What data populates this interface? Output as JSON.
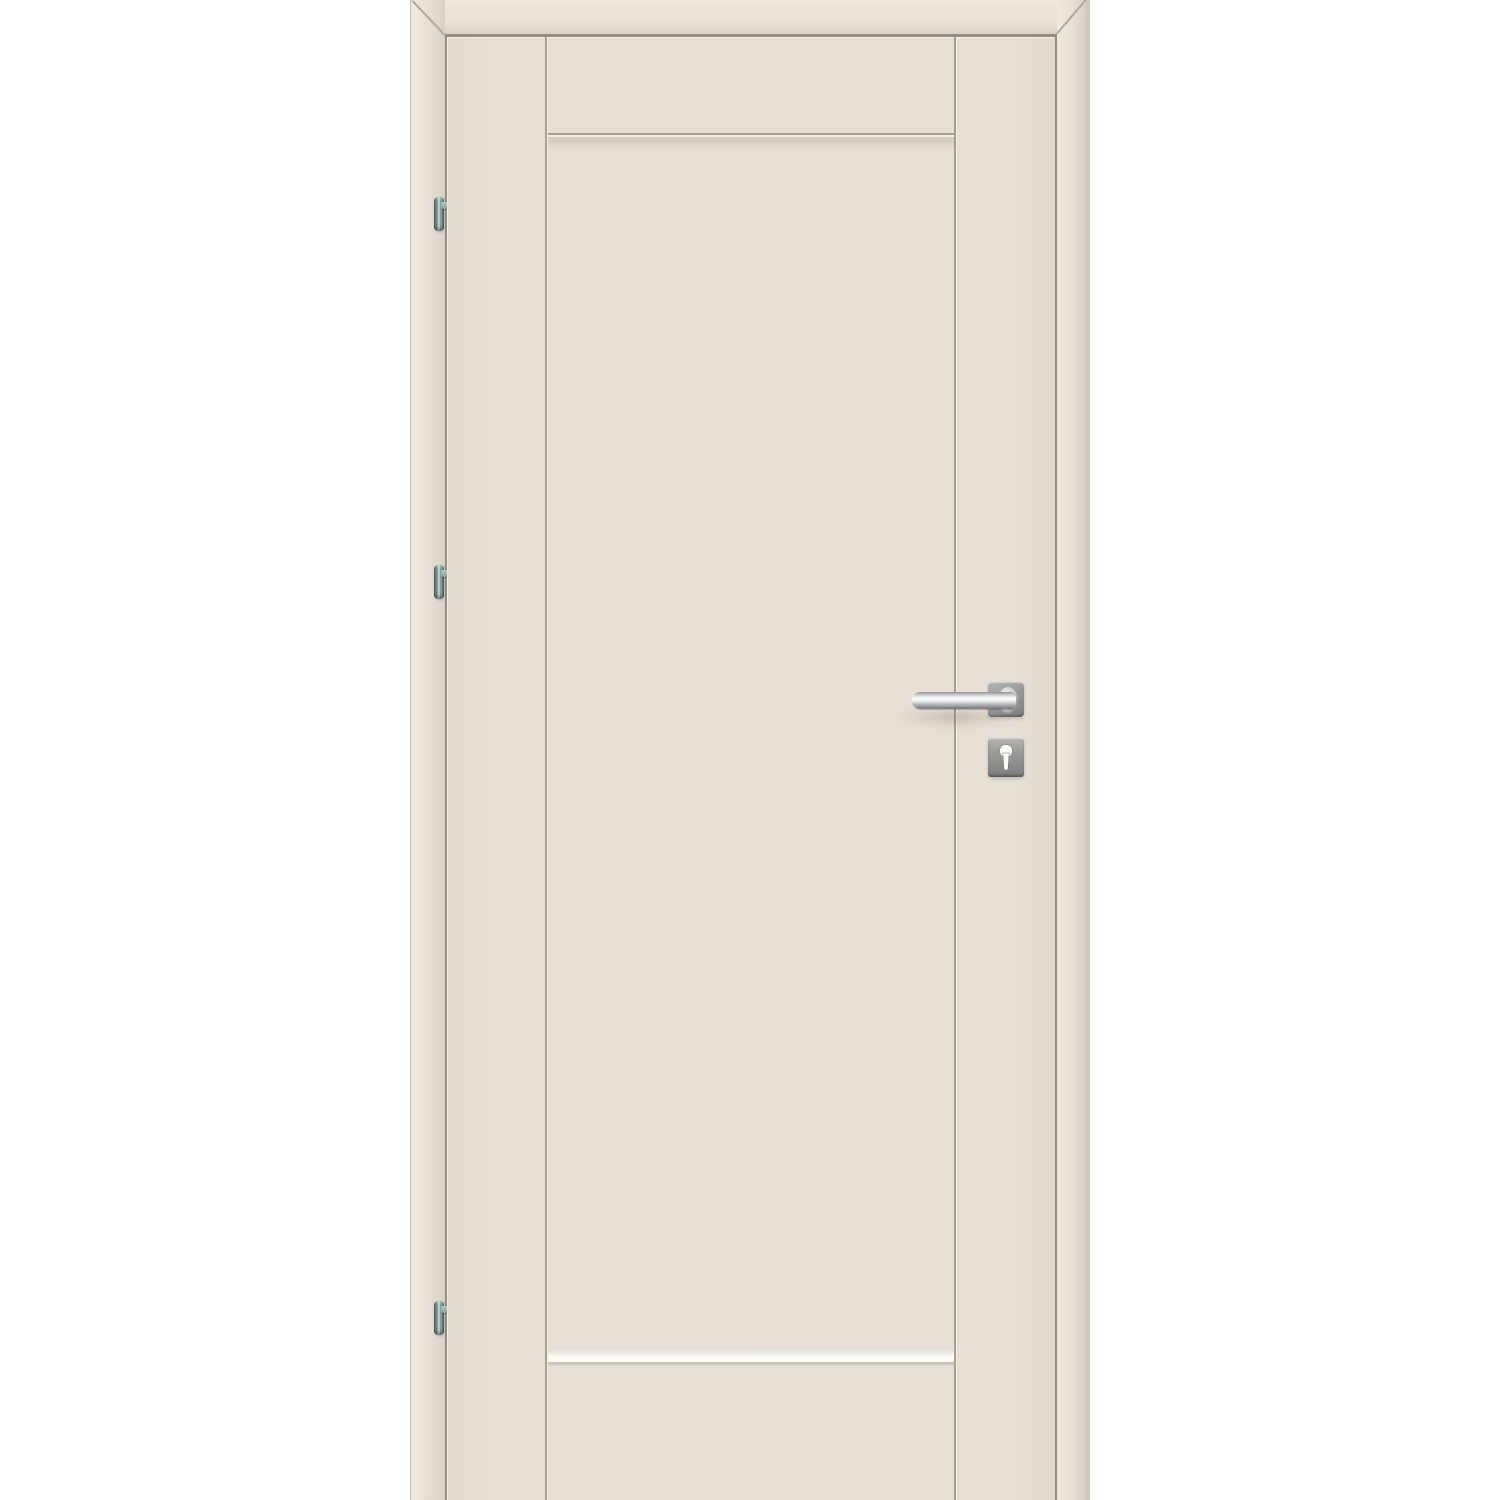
{
  "scene": {
    "subject": "single-panel interior door with frame, lever handle, keyhole escutcheon and three hinges",
    "hinge_count": 3,
    "text_content": ""
  },
  "colors": {
    "bg": "#ffffff",
    "door": "#e6dfd5",
    "door-dark": "#e1dacf",
    "casing": "#e7e0d6",
    "casing-light": "#eee8de",
    "casing-dark": "#d9d2c7",
    "casing-edge": "#c9c2b7",
    "edge-line": "#cfc8bd",
    "gap-line": "#948e85",
    "groove": "#a69f94",
    "groove-hi": "#f4efe8",
    "groove-hi2": "#fdfbf5",
    "miter-line": "#b2aa9e",
    "metal-hi": "#ffffff",
    "metal-mid": "#c2c4c6",
    "metal-dark": "#74767a",
    "plate": "#9c9c9a",
    "plate-light": "#b4b4b2",
    "plate-dark": "#7e7e7c",
    "hinge-dark": "#445c55",
    "hinge-mid": "#6a847d",
    "hinge-mid2": "#86a098",
    "hinge-light": "#b9cac4",
    "keyhole": "#fcfcf7",
    "soft-shadow": "rgba(95,88,76,0.30)"
  }
}
